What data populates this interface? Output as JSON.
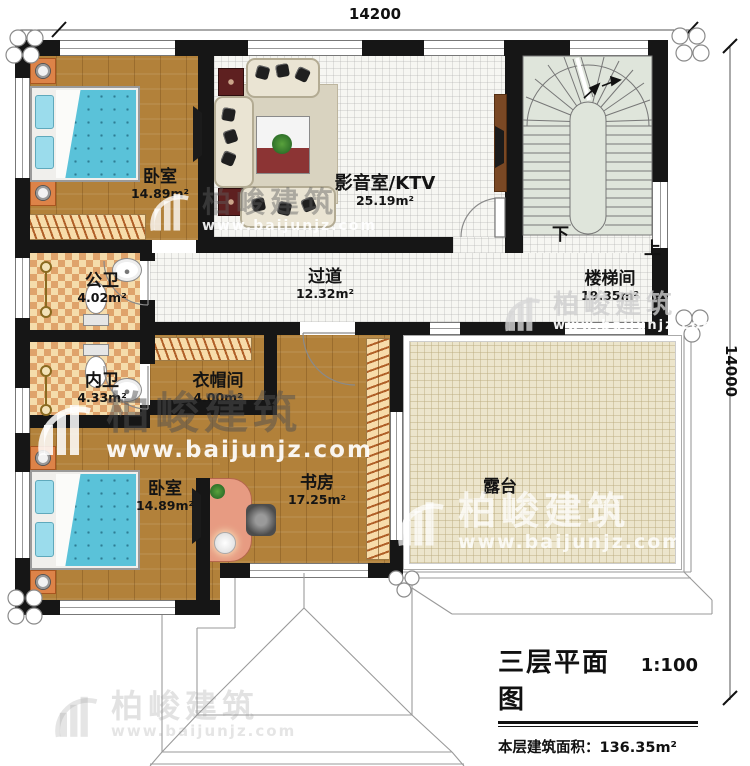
{
  "watermark": {
    "brand": "柏峻建筑",
    "url": "www.baijunjz.com"
  },
  "dimensions": {
    "top": "14200",
    "right": "14000"
  },
  "stairs": {
    "down": "下",
    "up": "上"
  },
  "rooms": {
    "bedroom1": {
      "name": "卧室",
      "area": "14.89m²"
    },
    "media": {
      "name": "影音室/KTV",
      "area": "25.19m²"
    },
    "corridor": {
      "name": "过道",
      "area": "12.32m²"
    },
    "stairwell": {
      "name": "楼梯间",
      "area": "19.35m²"
    },
    "public_bath": {
      "name": "公卫",
      "area": "4.02m²"
    },
    "inner_bath": {
      "name": "内卫",
      "area": "4.33m²"
    },
    "cloakroom": {
      "name": "衣帽间",
      "area": "4.00m²"
    },
    "study": {
      "name": "书房",
      "area": "17.25m²"
    },
    "bedroom2": {
      "name": "卧室",
      "area": "14.89m²"
    },
    "terrace": {
      "name": "露台"
    }
  },
  "title_block": {
    "title": "三层平面图",
    "scale": "1:100",
    "area_label": "本层建筑面积：136.35m²",
    "floor_height_label": "层高：3.3m"
  }
}
